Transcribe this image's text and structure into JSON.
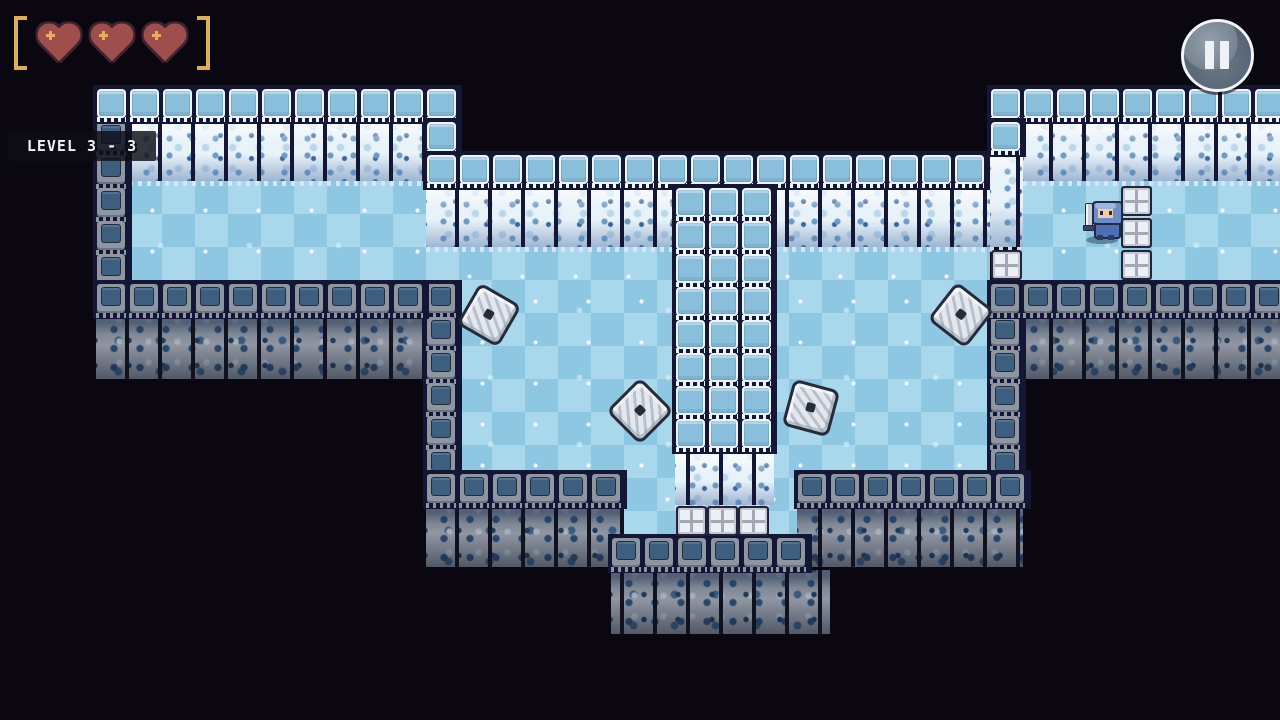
{
  "hud": {
    "level_label": "LEVEL 3 - 3",
    "health": {
      "hearts_filled": 3,
      "hearts_total": 3
    },
    "pause_button": "pause"
  },
  "palette": {
    "background": "#0a0710",
    "checker_light": "#a9d7eb",
    "checker_dark": "#8ec7e1",
    "ice_cap_fill": "#8abfdc",
    "ice_cap_frame": "#edf5fa",
    "ice_texture_base": "#e8f2f9",
    "stone_base": "#8f96a1",
    "stone_inset": "#3c5f80",
    "seam_dark": "#131735",
    "metal_light": "#eceff4",
    "heart_red": "#9e4f4b",
    "heart_outline": "#3f2230",
    "bracket_gold": "#dcae55",
    "saw_fill": "#e4e8ee",
    "saw_dark": "#262b3a"
  },
  "level": {
    "tile": 33,
    "floors": [
      [
        129,
        181,
        297,
        102
      ],
      [
        426,
        247,
        564,
        36
      ],
      [
        459,
        283,
        531,
        190
      ],
      [
        624,
        473,
        173,
        64
      ],
      [
        1020,
        181,
        260,
        102
      ]
    ],
    "ice_cap_rows": [
      [
        96,
        88,
        10
      ],
      [
        426,
        88,
        1
      ],
      [
        426,
        121,
        1
      ],
      [
        426,
        154,
        17
      ],
      [
        990,
        88,
        9
      ],
      [
        990,
        121,
        1
      ]
    ],
    "ice_cap_stacks": [
      [
        675,
        187,
        8
      ],
      [
        708,
        187,
        8
      ],
      [
        741,
        187,
        8
      ]
    ],
    "ice_textures": [
      [
        129,
        121,
        297,
        60
      ],
      [
        426,
        187,
        249,
        60
      ],
      [
        774,
        187,
        216,
        60
      ],
      [
        990,
        154,
        33,
        93
      ],
      [
        1023,
        121,
        257,
        60
      ],
      [
        675,
        451,
        99,
        54
      ]
    ],
    "stone_cap_rows": [
      [
        96,
        283,
        10
      ],
      [
        990,
        283,
        9
      ],
      [
        426,
        473,
        6
      ],
      [
        797,
        473,
        7
      ],
      [
        611,
        537,
        6
      ]
    ],
    "stone_textures": [
      [
        96,
        316,
        330,
        63
      ],
      [
        990,
        316,
        290,
        63
      ],
      [
        426,
        506,
        198,
        61
      ],
      [
        797,
        506,
        226,
        61
      ],
      [
        611,
        570,
        219,
        64
      ]
    ],
    "stone_edge_columns": [
      [
        96,
        121,
        5
      ],
      [
        426,
        283,
        6
      ],
      [
        990,
        283,
        6
      ]
    ],
    "metal_blocks": [
      [
        1121,
        186
      ],
      [
        1121,
        218
      ],
      [
        1121,
        250
      ],
      [
        991,
        250
      ],
      [
        676,
        506
      ],
      [
        707,
        506
      ],
      [
        738,
        506
      ]
    ],
    "saw_blades": [
      [
        486,
        312,
        30
      ],
      [
        637,
        408,
        45
      ],
      [
        808,
        405,
        15
      ],
      [
        958,
        312,
        38
      ]
    ],
    "player": {
      "x": 1085,
      "y": 201
    }
  }
}
